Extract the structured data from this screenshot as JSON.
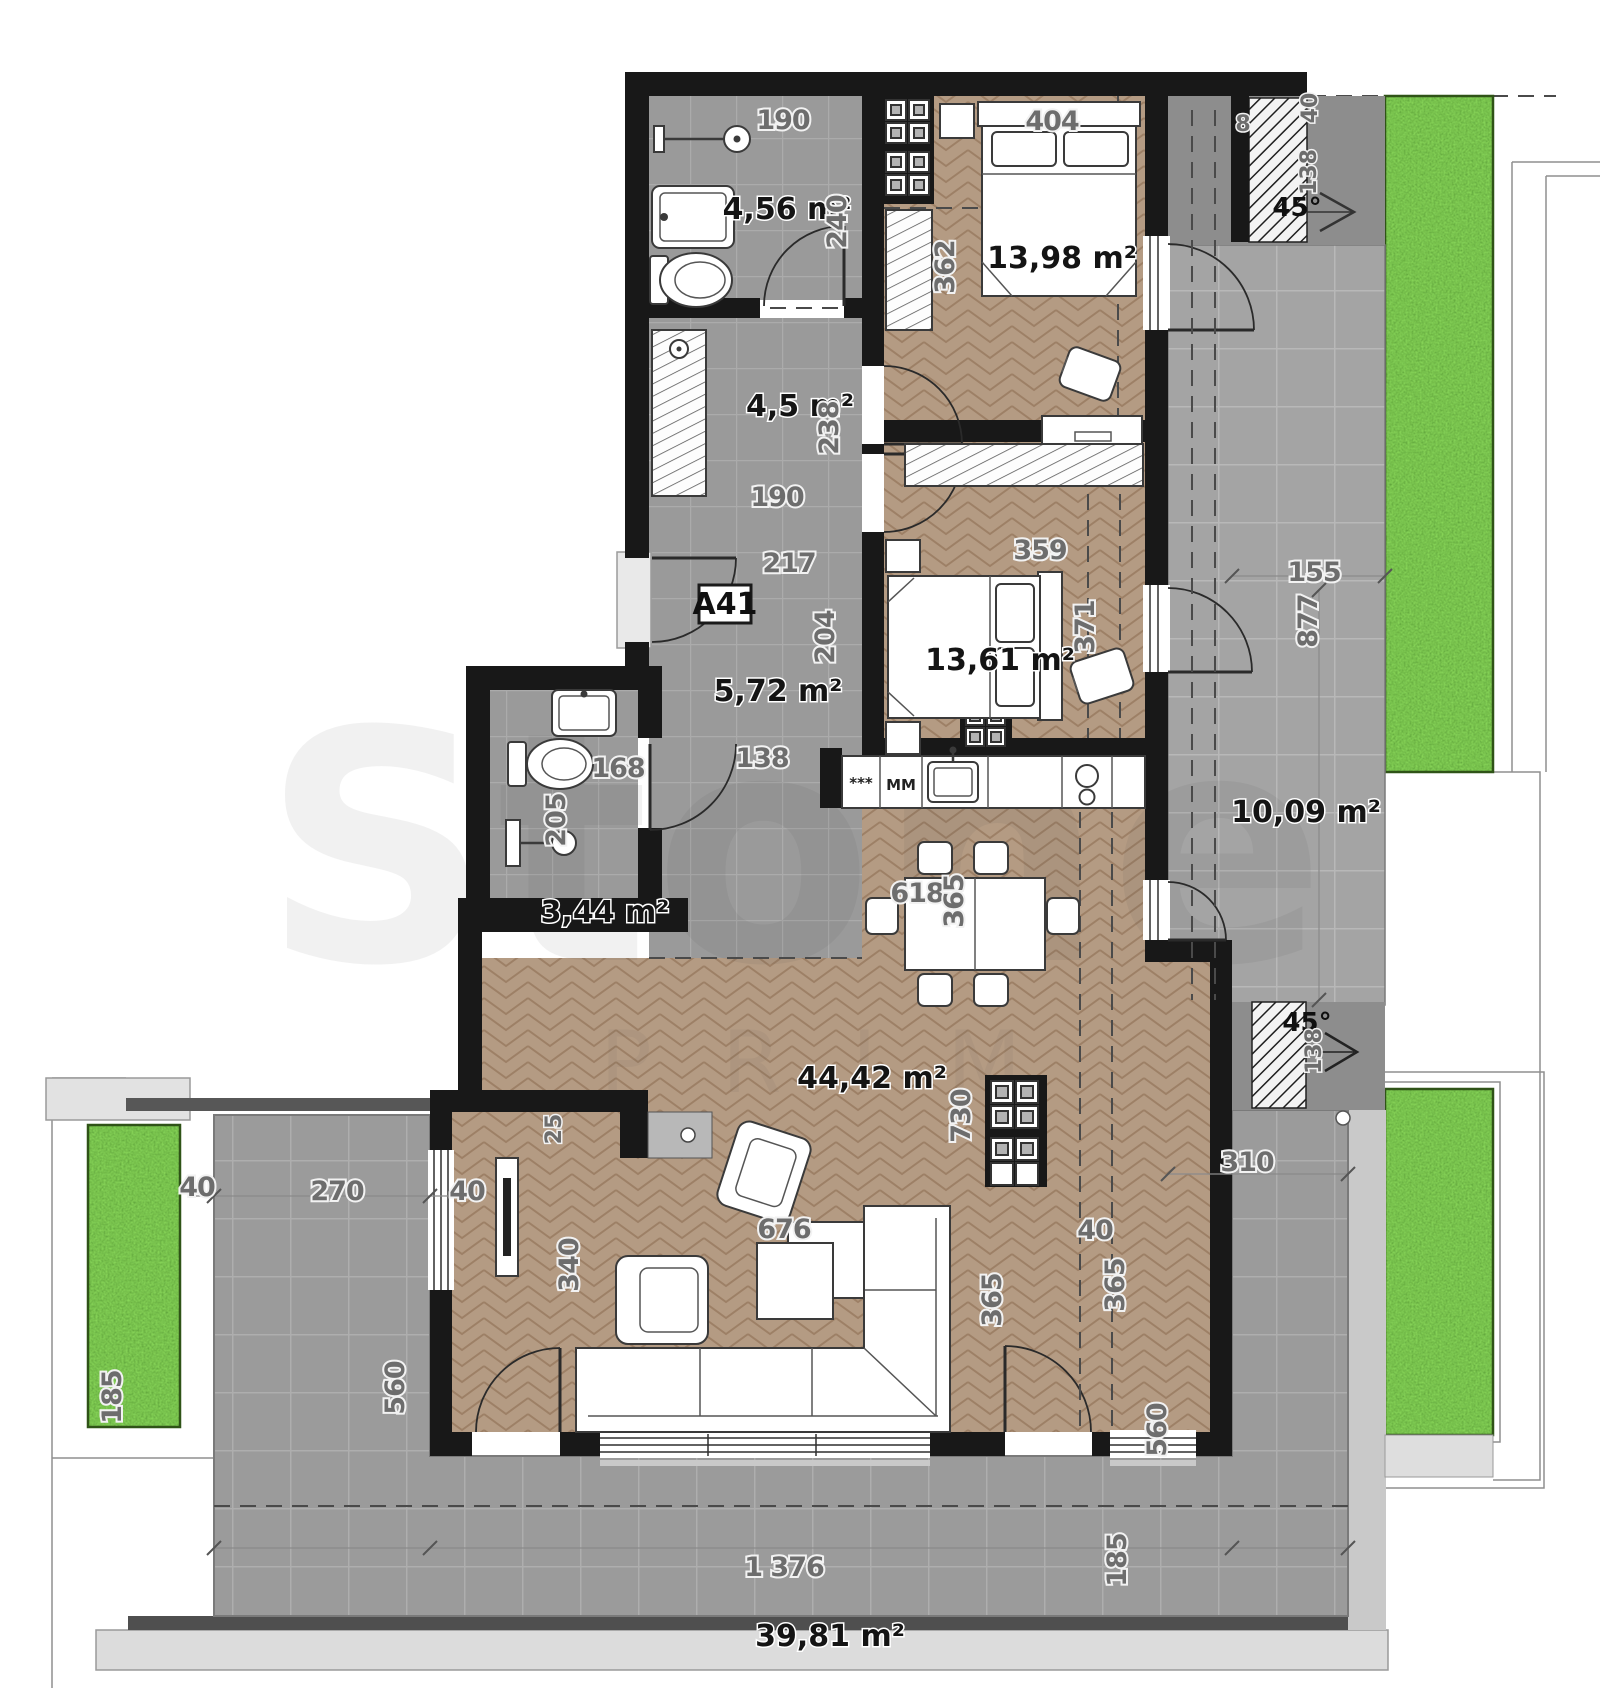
{
  "unit": {
    "badge": "A41"
  },
  "rooms": {
    "bath1": {
      "area": "4,56 m²"
    },
    "hall": {
      "area": "4,5 m²"
    },
    "bedroom1": {
      "area": "13,98 m²"
    },
    "entry": {
      "area": "5,72 m²"
    },
    "bath2": {
      "area": "3,44 m²"
    },
    "bedroom2": {
      "area": "13,61 m²"
    },
    "living": {
      "area": "44,42 m²"
    },
    "terrace_side": {
      "area": "10,09 m²"
    },
    "terrace_main": {
      "area": "39,81 m²"
    }
  },
  "angles": {
    "roof_top": "45°",
    "roof_bottom": "45°"
  },
  "kitchen": {
    "hob": "***",
    "dishwasher": "MM"
  },
  "watermark": {
    "primary": "Stone",
    "secondary": "PRIM"
  },
  "dims": {
    "bath_width": "190",
    "bath_height": "240",
    "hall_width": "190",
    "hall_height": "238",
    "entry_width": "217",
    "entry_clear": "138",
    "closet_depth": "204",
    "bedroom1_width": "404",
    "bedroom1_height": "362",
    "eave": "8",
    "eave_side": "40",
    "roof_top_run": "138",
    "side_terrace_width": "155",
    "side_terrace_height": "877",
    "bedroom2_width": "359",
    "bedroom2_height": "371",
    "bath2_width": "168",
    "bath2_height": "205",
    "dining_width": "618",
    "dining_depth": "365",
    "living_depth": "730",
    "living_width": "676",
    "window_left": "365",
    "wall_gap": "40",
    "edge_left": "40",
    "terrace_left_width": "270",
    "wall_left": "40",
    "terrace_left_height": "560",
    "tv_wall": "340",
    "tv_offset": "25",
    "roof_bottom_run": "138",
    "terrace_right_width": "310",
    "window_right": "365",
    "terrace_right_height": "560",
    "terrace_width": "1 376",
    "margin_left": "185",
    "margin_right": "185"
  }
}
